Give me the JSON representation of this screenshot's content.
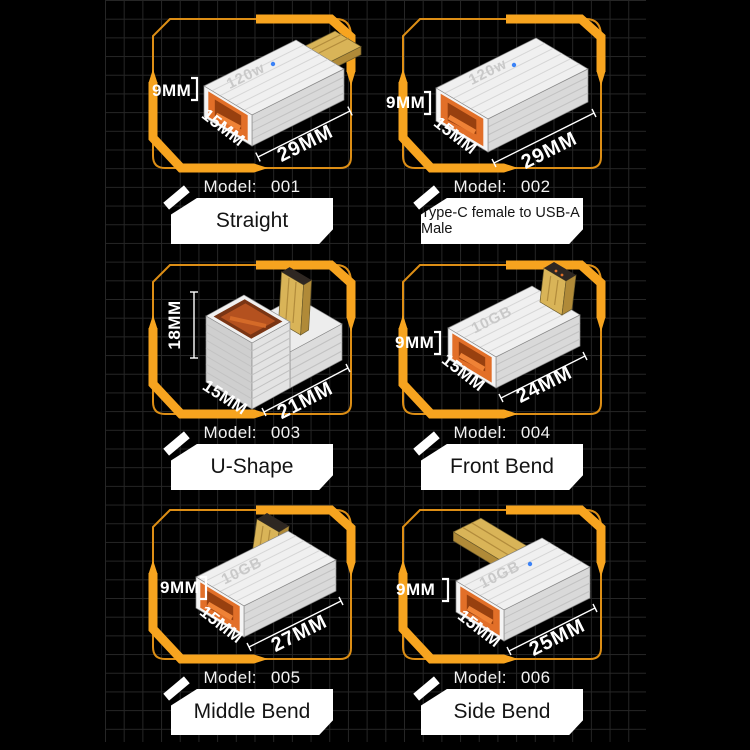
{
  "page": {
    "background": "#000000",
    "grid_line_color": "#262626",
    "frame_accent_color": "#F7A41F",
    "frame_outline_color": "#DD8E15",
    "label_box_color": "#FFFFFF",
    "dimension_text_color": "#FFFFFF",
    "port_color": "#E26F28",
    "plug_color": "#D9B458"
  },
  "cells": [
    {
      "model_label": "Model:",
      "model_value": "001",
      "shape": "Straight",
      "badge": "120w",
      "dims": {
        "height": "9MM",
        "width": "15MM",
        "length": "29MM"
      }
    },
    {
      "model_label": "Model:",
      "model_value": "002",
      "shape": "Type-C female to USB-A Male",
      "badge": "120w",
      "dims": {
        "height": "9MM",
        "width": "15MM",
        "length": "29MM"
      }
    },
    {
      "model_label": "Model:",
      "model_value": "003",
      "shape": "U-Shape",
      "dims": {
        "height": "18MM",
        "width": "15MM",
        "length": "21MM"
      }
    },
    {
      "model_label": "Model:",
      "model_value": "004",
      "shape": "Front Bend",
      "badge": "10GB",
      "dims": {
        "height": "9MM",
        "width": "15MM",
        "length": "24MM"
      }
    },
    {
      "model_label": "Model:",
      "model_value": "005",
      "shape": "Middle Bend",
      "badge": "10GB",
      "dims": {
        "height": "9MM",
        "width": "15MM",
        "length": "27MM"
      }
    },
    {
      "model_label": "Model:",
      "model_value": "006",
      "shape": "Side Bend",
      "badge": "10GB",
      "dims": {
        "height": "9MM",
        "width": "15MM",
        "length": "25MM"
      }
    }
  ]
}
